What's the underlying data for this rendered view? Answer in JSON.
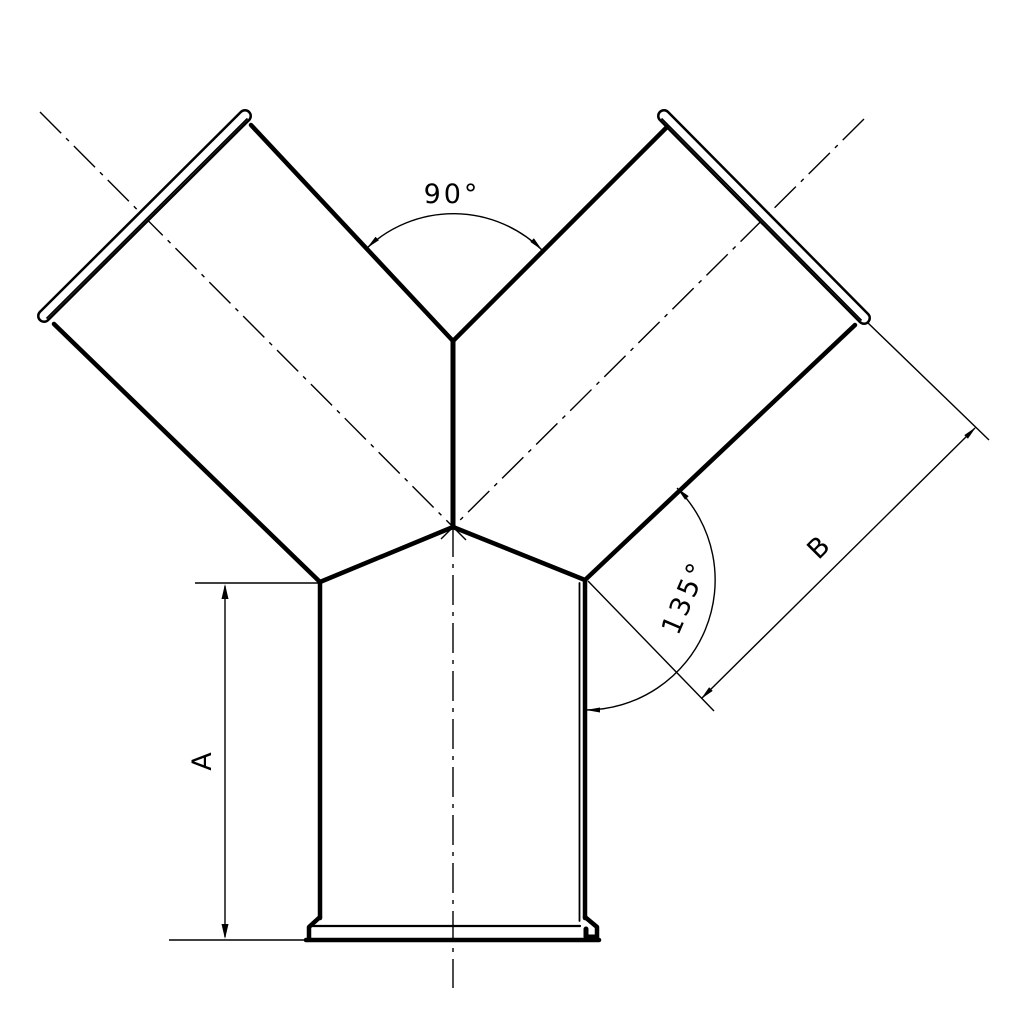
{
  "drawing": {
    "title": "wye-fitting-technical-drawing",
    "labels": {
      "top_angle": "90°",
      "branch_angle": "135°",
      "height_dim": "A",
      "branch_length_dim": "B"
    },
    "colors": {
      "line": "#000000",
      "background": "#ffffff"
    }
  }
}
